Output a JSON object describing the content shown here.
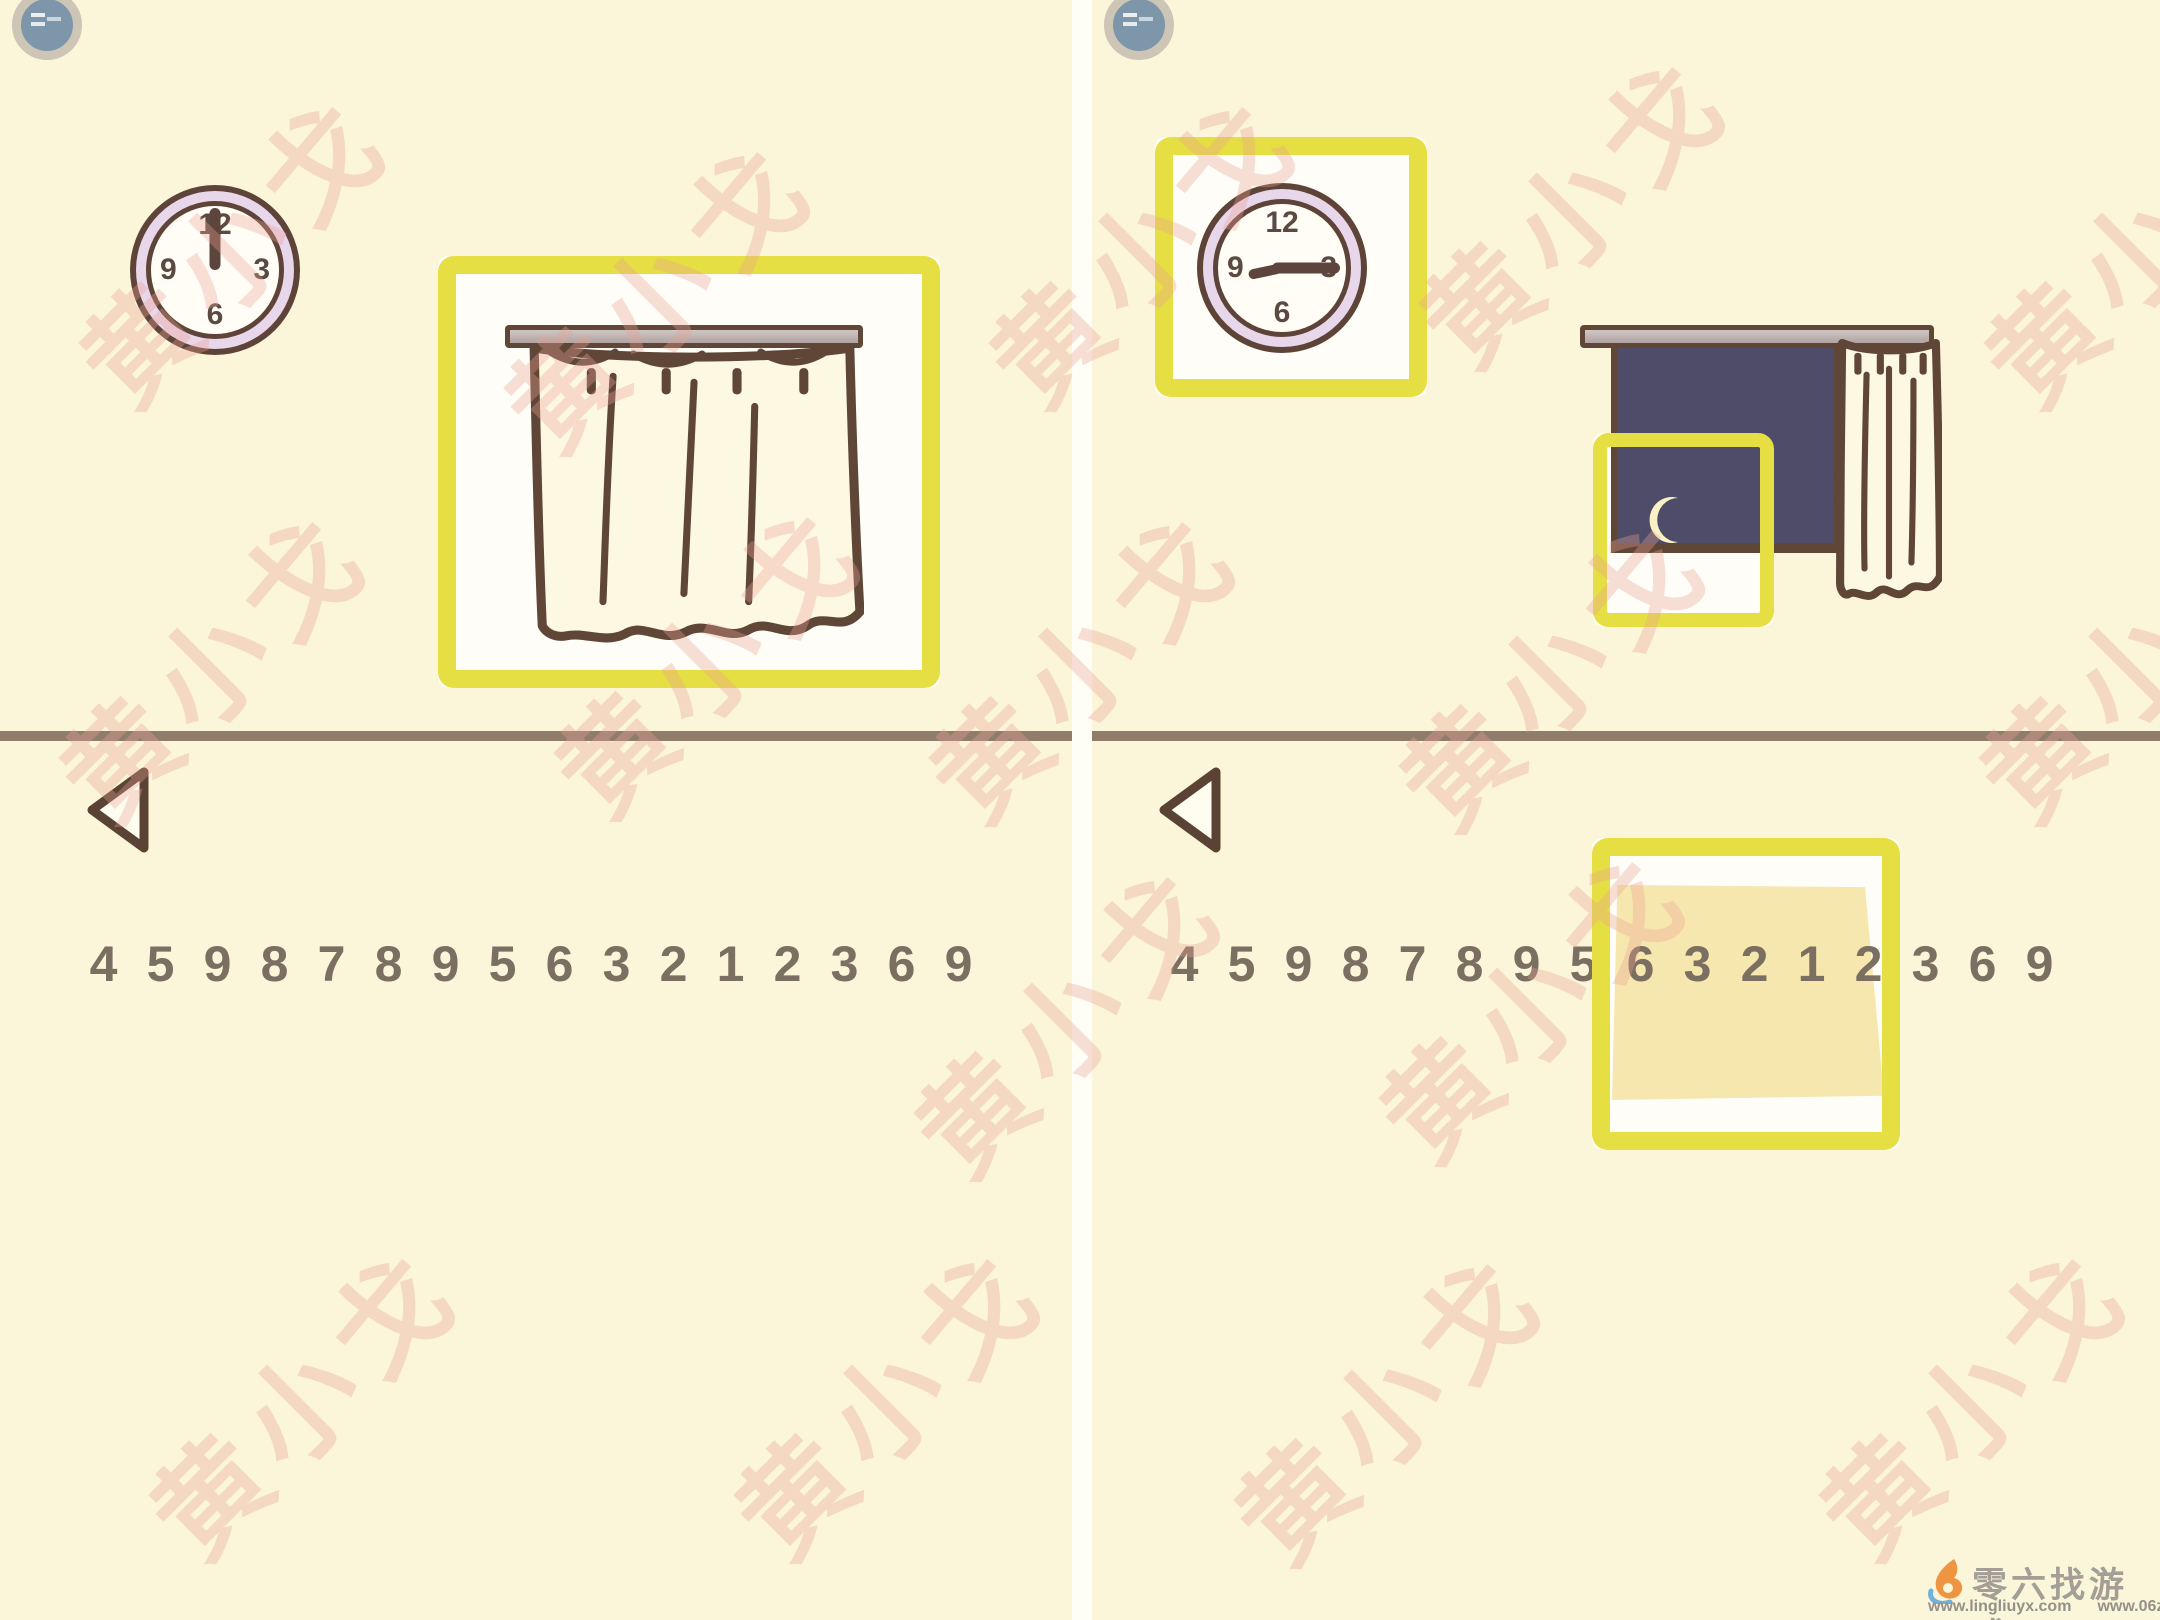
{
  "app": {
    "type": "puzzle-game walkthrough screenshot, two steps side by side",
    "scene": "room wall with clock and window"
  },
  "panels": [
    {
      "side": "left",
      "clock": {
        "time_shown": "12:00",
        "numerals": [
          "12",
          "3",
          "6",
          "9"
        ]
      },
      "window": {
        "state": "curtain closed"
      },
      "number_row": [
        "4",
        "5",
        "9",
        "8",
        "7",
        "8",
        "9",
        "5",
        "6",
        "3",
        "2",
        "1",
        "2",
        "3",
        "6",
        "9"
      ],
      "highlights": [
        {
          "target": "closed-curtain-window"
        }
      ]
    },
    {
      "side": "right",
      "clock": {
        "time_shown": "about 2:45 (long hand to 3, short hand lower-left)",
        "numerals": [
          "12",
          "3",
          "6",
          "9"
        ]
      },
      "window": {
        "state": "curtain drawn open, night sky with crescent moon"
      },
      "number_row": [
        "4",
        "5",
        "9",
        "8",
        "7",
        "8",
        "9",
        "5",
        "6",
        "3",
        "2",
        "1",
        "2",
        "3",
        "6",
        "9"
      ],
      "highlights": [
        {
          "target": "wall-clock"
        },
        {
          "target": "window-lower-left-with-moon"
        },
        {
          "target": "answer-note-over-digits"
        }
      ],
      "note_digits": [
        "6",
        "3",
        "2",
        "1",
        "2"
      ]
    }
  ],
  "watermark": {
    "text": "黄小戈",
    "color": "#eba094"
  },
  "footer": {
    "brand": "零六找游戏",
    "urls": [
      "www.lingliuyx.com",
      "www.06zyx.com"
    ]
  },
  "colors": {
    "background": "#fbf5d9",
    "highlight_yellow": "#e6df43",
    "outline_brown": "#5f4637",
    "divider": "#8f7c6b",
    "digits": "#7b6f62",
    "clock_ring": "#e8d6ea",
    "night_sky": "#4e4c68",
    "moon": "#faf2c6",
    "note": "#f6e7ae",
    "badge_blue": "#7e96aa"
  }
}
